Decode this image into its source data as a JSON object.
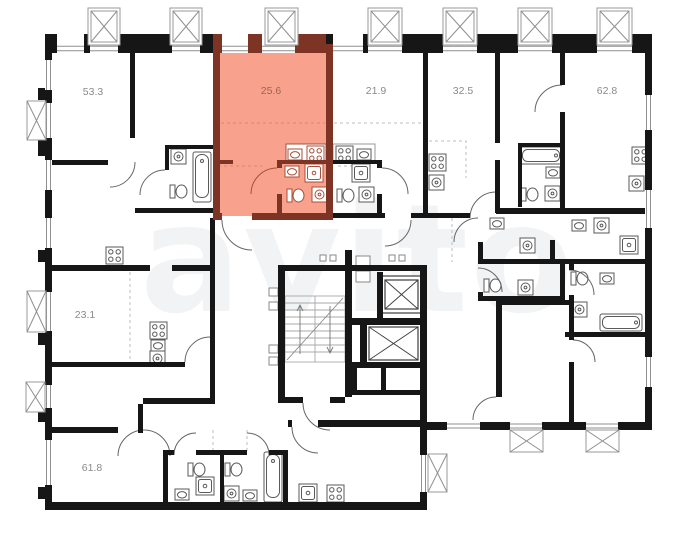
{
  "watermark": "avito",
  "colors": {
    "highlight_fill": "#f8a28e",
    "highlight_wall": "#7e3424",
    "wall": "#161616",
    "label": "#8a8a8a",
    "highlight_label": "#9c6455",
    "watermark": "rgba(130,140,150,0.10)"
  },
  "units": [
    {
      "name": "apartment-53-3",
      "area": "53.3",
      "highlighted": false
    },
    {
      "name": "apartment-25-6",
      "area": "25.6",
      "highlighted": true
    },
    {
      "name": "apartment-21-9",
      "area": "21.9",
      "highlighted": false
    },
    {
      "name": "apartment-32-5",
      "area": "32.5",
      "highlighted": false
    },
    {
      "name": "apartment-62-8",
      "area": "62.8",
      "highlighted": false
    },
    {
      "name": "apartment-23-1",
      "area": "23.1",
      "highlighted": false
    },
    {
      "name": "apartment-61-8",
      "area": "61.8",
      "highlighted": false
    }
  ],
  "icons": [
    "balcony-icon",
    "window-icon",
    "bathtub-icon",
    "toilet-icon",
    "sink-icon",
    "stove-icon",
    "washing-machine-icon",
    "shower-icon",
    "staircase-icon",
    "elevator-icon",
    "door-arc-icon"
  ]
}
